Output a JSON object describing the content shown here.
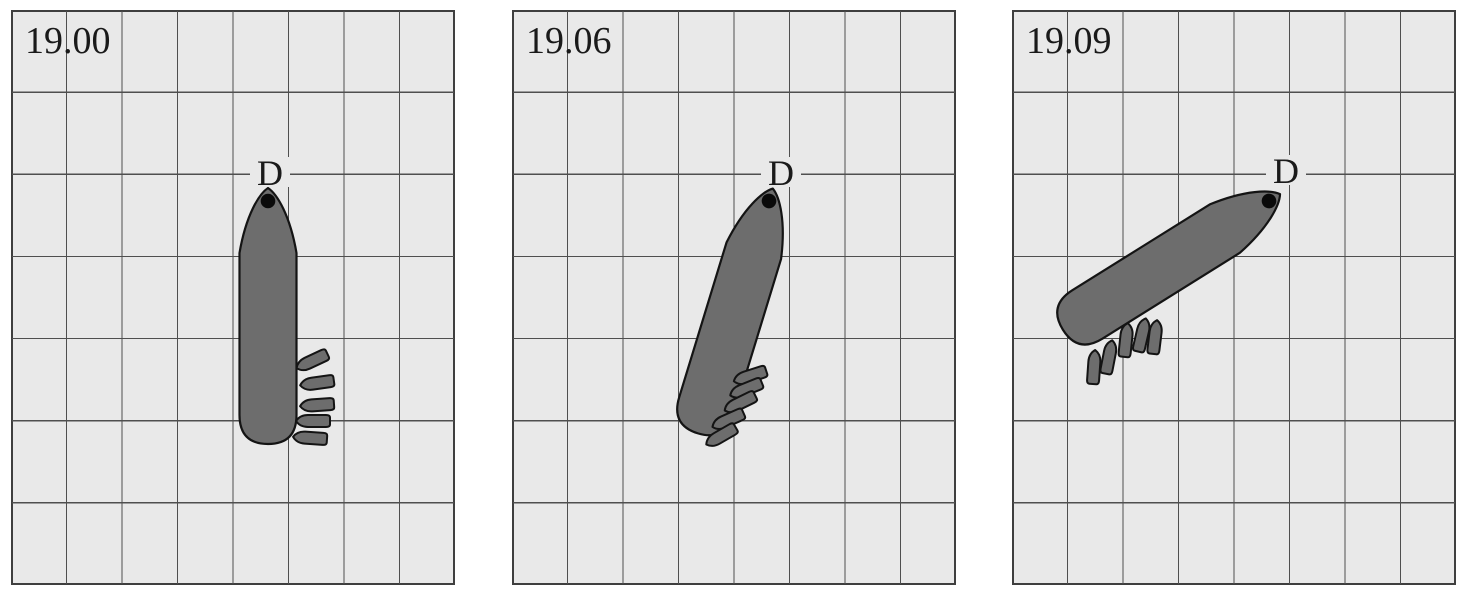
{
  "figure": {
    "subject": "ship-turning-with-tugboats-time-sequence",
    "point_label": "D",
    "colors": {
      "page_bg": "#ffffff",
      "panel_bg": "#e9e9e9",
      "grid_line": "#4f4f4f",
      "panel_border": "#3f3f3f",
      "hull_fill": "#6d6d6d",
      "hull_outline": "#141414",
      "dot": "#0a0a0a",
      "text": "#1a1a1a"
    },
    "grid": {
      "columns": 8,
      "rows": 7
    },
    "panels": [
      {
        "time": "19.00",
        "point_label": "D",
        "label_x": "259",
        "label_y": "175",
        "pivot_x": 257,
        "pivot_y": 191,
        "heading_deg": 0,
        "tugs": [
          {
            "x": 301,
            "y": 351,
            "rot": -25
          },
          {
            "x": 306,
            "y": 373,
            "rot": -8
          },
          {
            "x": 306,
            "y": 395,
            "rot": -4
          },
          {
            "x": 302,
            "y": 411,
            "rot": 0
          },
          {
            "x": 299,
            "y": 428,
            "rot": 4
          }
        ]
      },
      {
        "time": "19.06",
        "point_label": "D",
        "label_x": "269",
        "label_y": "175",
        "pivot_x": 257,
        "pivot_y": 191,
        "heading_deg": 17,
        "tugs": [
          {
            "x": 238,
            "y": 366,
            "rot": -18
          },
          {
            "x": 234,
            "y": 379,
            "rot": -22
          },
          {
            "x": 228,
            "y": 393,
            "rot": -26
          },
          {
            "x": 216,
            "y": 410,
            "rot": -24
          },
          {
            "x": 209,
            "y": 426,
            "rot": -30
          }
        ]
      },
      {
        "time": "19.09",
        "point_label": "D",
        "label_x": "274",
        "label_y": "173",
        "pivot_x": 257,
        "pivot_y": 191,
        "heading_deg": 58,
        "tugs": [
          {
            "x": 82,
            "y": 357,
            "rot": 94
          },
          {
            "x": 97,
            "y": 347,
            "rot": 101
          },
          {
            "x": 114,
            "y": 330,
            "rot": 96
          },
          {
            "x": 130,
            "y": 325,
            "rot": 103
          },
          {
            "x": 143,
            "y": 327,
            "rot": 97
          }
        ]
      }
    ]
  }
}
